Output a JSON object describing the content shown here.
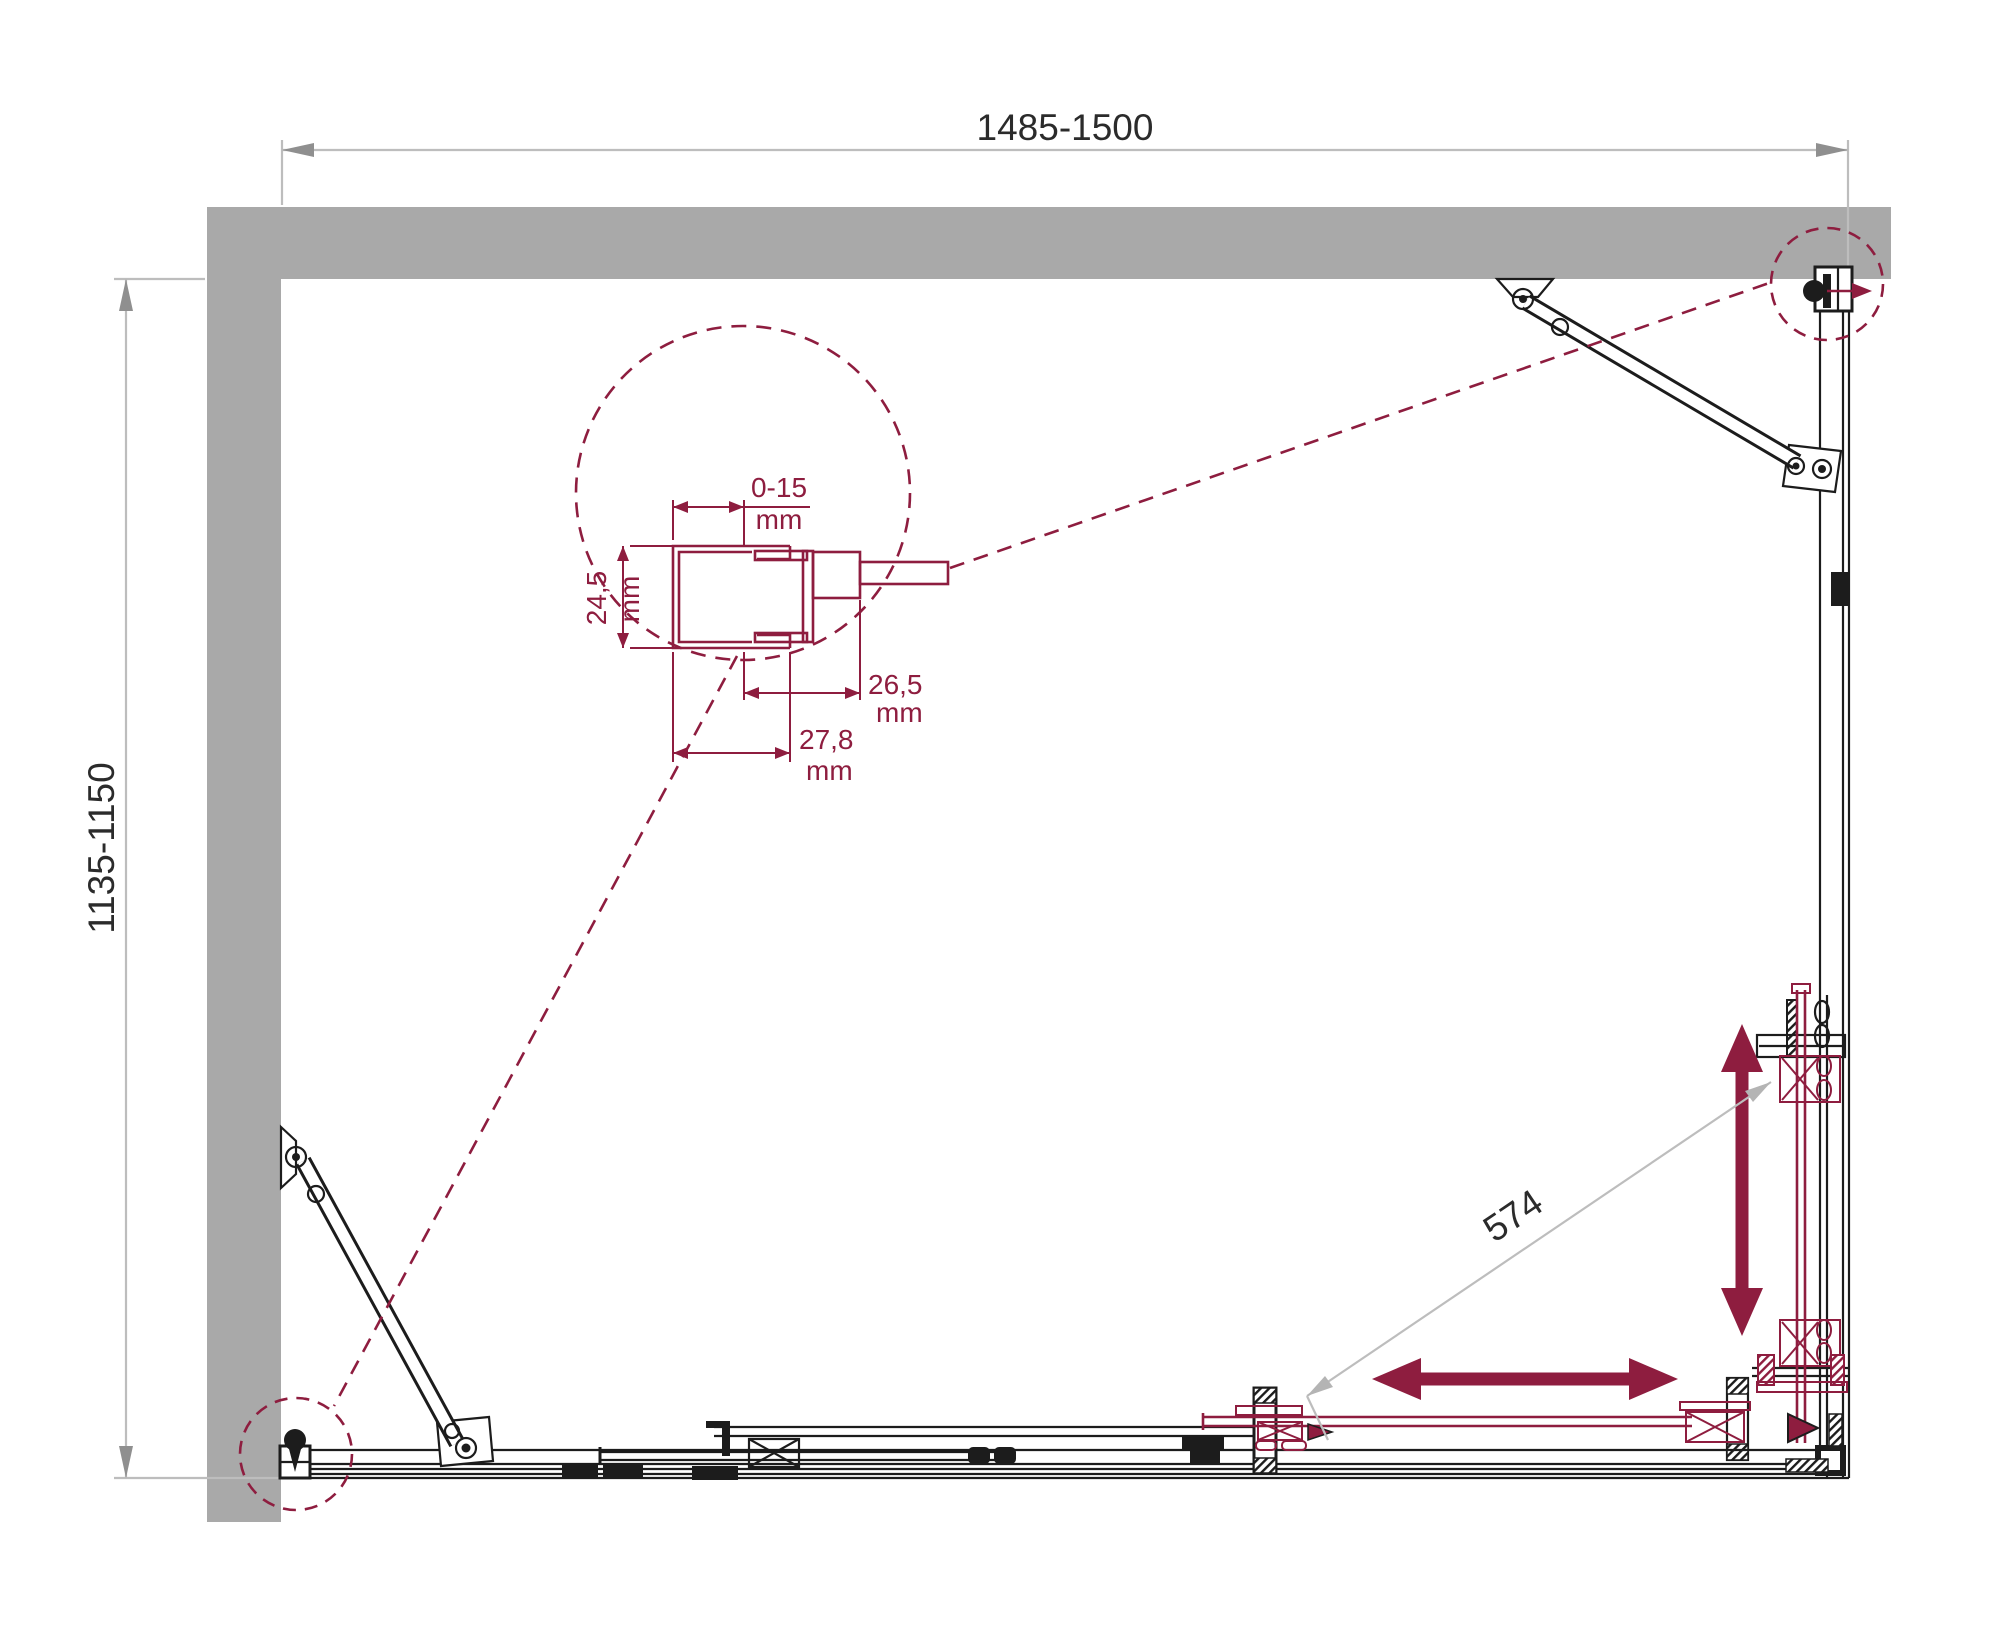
{
  "colors": {
    "wall_fill": "#a9a9a9",
    "drawing_line": "#1c1c1c",
    "accent_maroon": "#8e1d3f",
    "dimension_line": "#bdbdbd",
    "dimension_arrow": "#8f8f8f",
    "dimension_text": "#2b2b2b"
  },
  "dimensions": {
    "top_width": {
      "label": "1485-1500"
    },
    "left_depth": {
      "label": "1135-1150"
    },
    "diagonal_entry": {
      "label": "574"
    }
  },
  "detail": {
    "adjustment": {
      "value": "0-15",
      "unit": "mm"
    },
    "profile_depth": {
      "value": "24,5",
      "unit": "mm"
    },
    "inner_width": {
      "value": "26,5",
      "unit": "mm"
    },
    "outer_width": {
      "value": "27,8",
      "unit": "mm"
    }
  }
}
